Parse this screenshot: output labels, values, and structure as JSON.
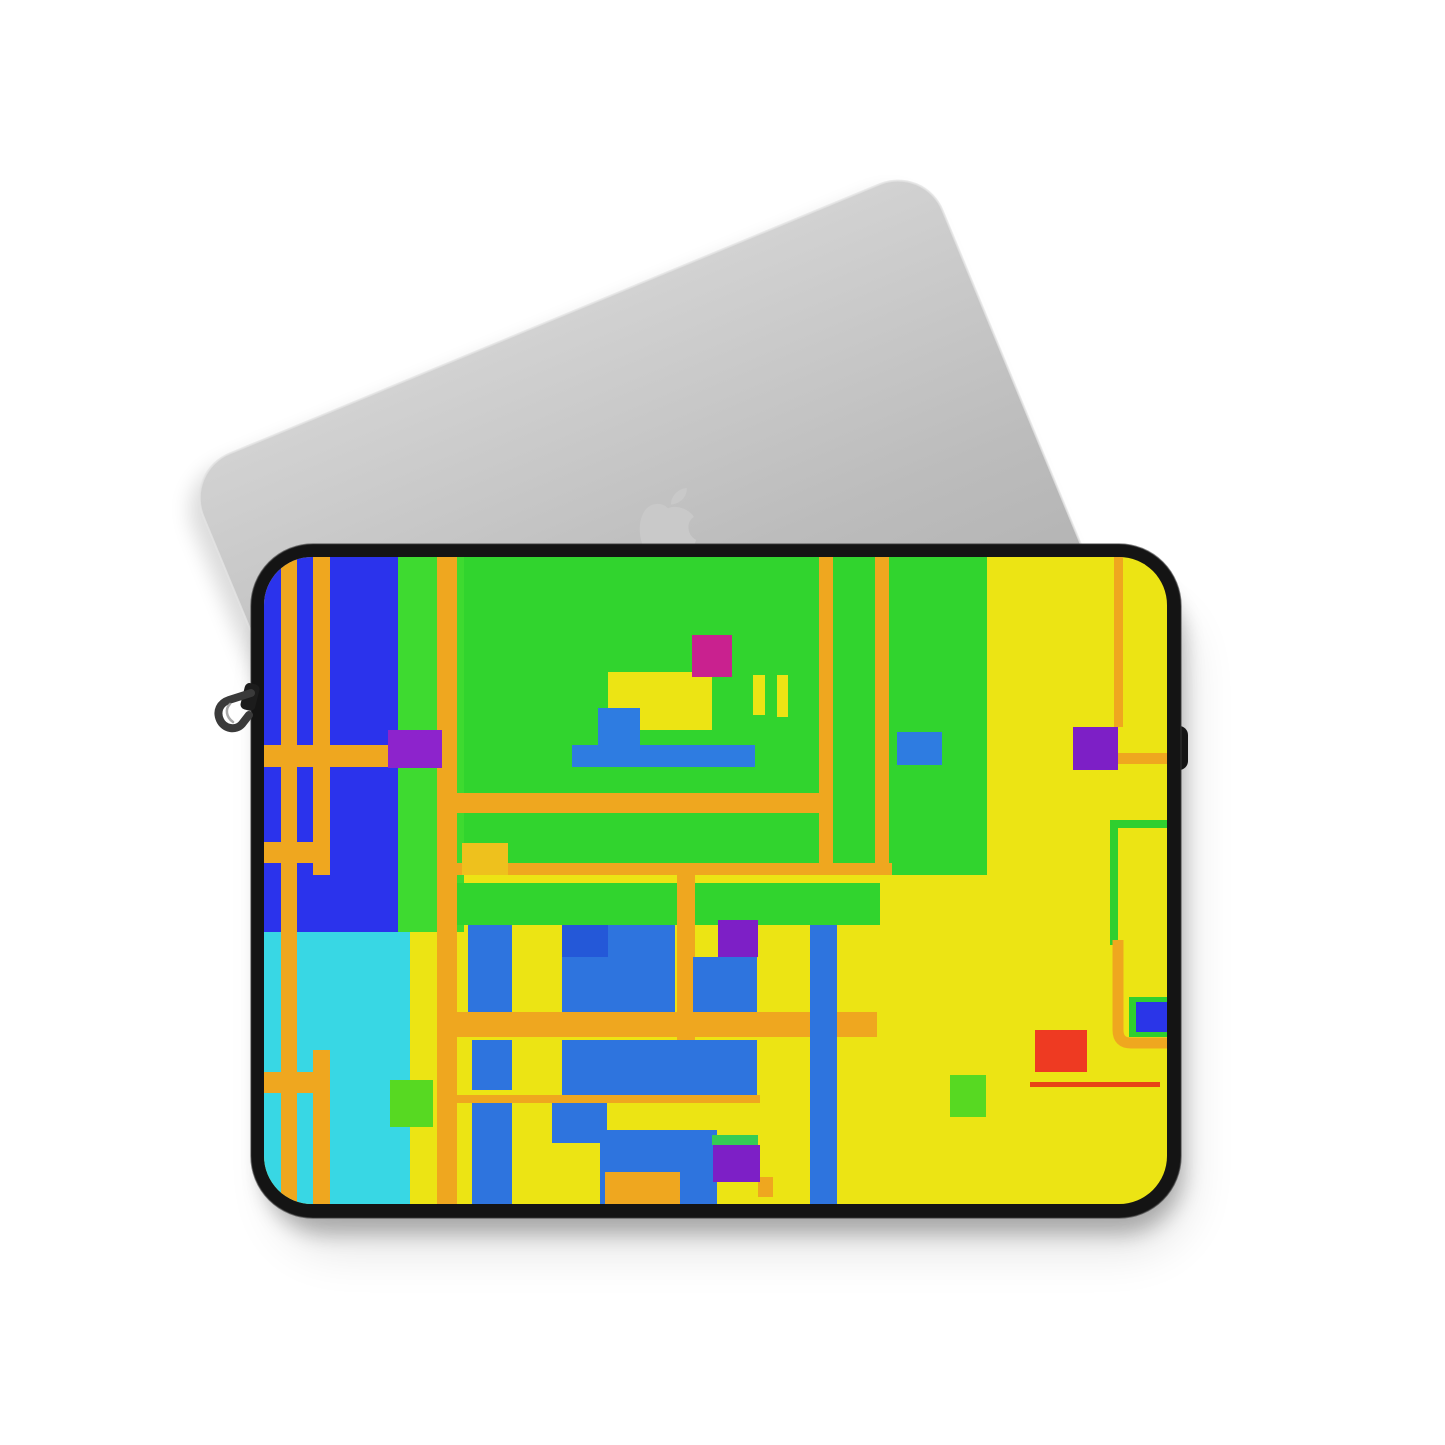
{
  "scene": {
    "background_color": "#ffffff",
    "width": 1445,
    "height": 1445,
    "objects": [
      "macbook-lid",
      "apple-logo",
      "laptop-sleeve",
      "zipper-pull"
    ]
  },
  "palette": {
    "laptop_gray_top": "#d0d0d0",
    "laptop_gray_bottom": "#a8a8a8",
    "laptop_rim": "#e4e4e4",
    "logo_gray": "#c9c9c9",
    "piping_black": "#141414",
    "piping_highlight": "#3a3a3a",
    "base_yellow": "#ece414",
    "field_blue": "#2b33ec",
    "field_cyan": "#38d7e4",
    "green_main": "#31d42e",
    "green_column": "#3eda30",
    "green_bright": "#2fcf2f",
    "orange": "#efa71f",
    "gold": "#eec11d",
    "motif_blue": "#2e7ce1",
    "bottom_blue": "#2e74de",
    "deep_blue": "#2458d8",
    "accent_blue": "#2a35e8",
    "magenta": "#c9218f",
    "purple": "#8d23cc",
    "purple_dark": "#7d1fc6",
    "red": "#ee3a22",
    "red_line": "#e84416",
    "small_green": "#57d922",
    "green_strip": "#35cc55",
    "zipper_metal": "#3a3a3a",
    "zipper_highlight": "#9a9a9a"
  },
  "laptop": {
    "x": 185,
    "y": 472,
    "rotation_deg": -22.5,
    "width": 800,
    "height": 640,
    "corner_radius": 48,
    "shadow": {
      "dx": -10,
      "dy": 12,
      "blur": 10,
      "opacity": 0.14
    },
    "logo": {
      "x": 632,
      "y": 483,
      "scale": 0.72,
      "body_path": "M50,35 C42,26 26,27 18,38 C6,55 10,85 22,99 C28,106 35,107 42,103 C47,100 53,100 58,103 C65,107 72,106 78,99 C83,93 87,86 89,79 C77,73 74,55 86,47 C78,35 60,30 50,35 Z",
      "leaf_path": "M54,30 C54,18 64,8 76,7 C77,19 67,29 54,30 Z"
    }
  },
  "sleeve": {
    "outer": {
      "x": 251,
      "y": 544,
      "w": 930,
      "h": 674,
      "r": 62
    },
    "inner": {
      "x": 264,
      "y": 557,
      "w": 903,
      "h": 647,
      "r": 48
    },
    "right_tab": {
      "x": 1162,
      "y": 726,
      "w": 26,
      "h": 44,
      "r": 9
    },
    "shadow1": {
      "x": 262,
      "y": 576,
      "w": 922,
      "h": 658,
      "r": 64,
      "blur": 14,
      "opacity": 0.26
    },
    "shadow2": {
      "x": 274,
      "y": 604,
      "w": 916,
      "h": 648,
      "r": 64,
      "blur": 26,
      "opacity": 0.1
    },
    "zipper": {
      "slider": {
        "x": 246,
        "y": 682,
        "w": 15,
        "h": 27,
        "r": 5,
        "rot": 14
      },
      "hook_path": "M251,693 L229,700 C220,703 216,711 220,720 C224,729 236,731 242,724 L249,715",
      "hook_width": 8,
      "highlight_path": "M230,704 C225,709 226,717 233,722",
      "highlight_width": 2.5
    }
  },
  "pattern": {
    "shapes": [
      {
        "type": "rect",
        "x": 264,
        "y": 557,
        "w": 134,
        "h": 375,
        "fill": "field_blue",
        "name": "blue-field"
      },
      {
        "type": "rect",
        "x": 264,
        "y": 932,
        "w": 146,
        "h": 272,
        "fill": "field_cyan",
        "name": "cyan-field"
      },
      {
        "type": "rect",
        "x": 398,
        "y": 557,
        "w": 66,
        "h": 375,
        "fill": "green_column",
        "name": "green-column"
      },
      {
        "type": "rect",
        "x": 464,
        "y": 557,
        "w": 523,
        "h": 318,
        "fill": "green_main",
        "name": "green-field"
      },
      {
        "type": "rect",
        "x": 457,
        "y": 883,
        "w": 423,
        "h": 42,
        "fill": "green_main",
        "name": "green-band"
      },
      {
        "type": "rect",
        "x": 281,
        "y": 557,
        "w": 16,
        "h": 647,
        "fill": "orange",
        "name": "orange-stripe-a"
      },
      {
        "type": "rect",
        "x": 313,
        "y": 557,
        "w": 17,
        "h": 318,
        "fill": "orange",
        "name": "orange-stripe-b"
      },
      {
        "type": "rect",
        "x": 313,
        "y": 1050,
        "w": 17,
        "h": 154,
        "fill": "orange",
        "name": "orange-stripe-b2"
      },
      {
        "type": "rect",
        "x": 437,
        "y": 557,
        "w": 20,
        "h": 647,
        "fill": "orange",
        "name": "orange-stripe-c"
      },
      {
        "type": "rect",
        "x": 819,
        "y": 557,
        "w": 14,
        "h": 318,
        "fill": "orange",
        "name": "orange-stripe-d"
      },
      {
        "type": "rect",
        "x": 875,
        "y": 557,
        "w": 14,
        "h": 318,
        "fill": "orange",
        "name": "orange-stripe-e"
      },
      {
        "type": "rect",
        "x": 264,
        "y": 745,
        "w": 134,
        "h": 22,
        "fill": "orange",
        "name": "orange-band-left-1"
      },
      {
        "type": "rect",
        "x": 264,
        "y": 842,
        "w": 66,
        "h": 21,
        "fill": "orange",
        "name": "orange-band-left-2"
      },
      {
        "type": "rect",
        "x": 264,
        "y": 1072,
        "w": 63,
        "h": 21,
        "fill": "orange",
        "name": "orange-band-left-3"
      },
      {
        "type": "rect",
        "x": 457,
        "y": 793,
        "w": 367,
        "h": 20,
        "fill": "orange",
        "name": "orange-band-center-1"
      },
      {
        "type": "rect",
        "x": 443,
        "y": 863,
        "w": 449,
        "h": 12,
        "fill": "orange",
        "name": "orange-band-center-2"
      },
      {
        "type": "rect",
        "x": 677,
        "y": 875,
        "w": 18,
        "h": 165,
        "fill": "orange",
        "name": "orange-connector"
      },
      {
        "type": "rect",
        "x": 447,
        "y": 1012,
        "w": 430,
        "h": 25,
        "fill": "orange",
        "name": "orange-band-bottom"
      },
      {
        "type": "rect",
        "x": 447,
        "y": 1095,
        "w": 313,
        "h": 8,
        "fill": "orange",
        "name": "orange-thin-line"
      },
      {
        "type": "rect",
        "x": 1114,
        "y": 557,
        "w": 9,
        "h": 170,
        "fill": "orange",
        "name": "orange-right-vertical"
      },
      {
        "type": "rect",
        "x": 1118,
        "y": 753,
        "w": 53,
        "h": 11,
        "fill": "orange",
        "name": "orange-right-horizontal"
      },
      {
        "type": "rect",
        "x": 608,
        "y": 672,
        "w": 104,
        "h": 58,
        "fill": "base_yellow",
        "name": "motif-yellow-block"
      },
      {
        "type": "rect",
        "x": 462,
        "y": 843,
        "w": 46,
        "h": 32,
        "fill": "gold",
        "name": "gold-block"
      },
      {
        "type": "rect",
        "x": 692,
        "y": 635,
        "w": 40,
        "h": 42,
        "fill": "magenta",
        "name": "magenta-square"
      },
      {
        "type": "rect",
        "x": 753,
        "y": 675,
        "w": 12,
        "h": 40,
        "fill": "base_yellow",
        "name": "yellow-tick-1"
      },
      {
        "type": "rect",
        "x": 777,
        "y": 675,
        "w": 11,
        "h": 42,
        "fill": "base_yellow",
        "name": "yellow-tick-2"
      },
      {
        "type": "rect",
        "x": 598,
        "y": 708,
        "w": 42,
        "h": 37,
        "fill": "motif_blue",
        "name": "motif-blue-vertical"
      },
      {
        "type": "rect",
        "x": 572,
        "y": 745,
        "w": 183,
        "h": 22,
        "fill": "motif_blue",
        "name": "motif-blue-bar"
      },
      {
        "type": "rect",
        "x": 388,
        "y": 730,
        "w": 54,
        "h": 38,
        "fill": "purple",
        "name": "purple-square-left"
      },
      {
        "type": "rect",
        "x": 1073,
        "y": 727,
        "w": 45,
        "h": 43,
        "fill": "purple_dark",
        "name": "purple-square-right"
      },
      {
        "type": "rect",
        "x": 897,
        "y": 732,
        "w": 45,
        "h": 33,
        "fill": "motif_blue",
        "name": "blue-square-on-green"
      },
      {
        "type": "rect",
        "x": 1110,
        "y": 820,
        "w": 61,
        "h": 8,
        "fill": "green_bright",
        "name": "green-frame-top"
      },
      {
        "type": "rect",
        "x": 1110,
        "y": 820,
        "w": 8,
        "h": 125,
        "fill": "green_bright",
        "name": "green-frame-left"
      },
      {
        "type": "rect",
        "x": 718,
        "y": 920,
        "w": 40,
        "h": 37,
        "fill": "purple_dark",
        "name": "purple-square-mid"
      },
      {
        "type": "rect",
        "x": 468,
        "y": 925,
        "w": 44,
        "h": 87,
        "fill": "bottom_blue",
        "name": "blue-column-1"
      },
      {
        "type": "rect",
        "x": 562,
        "y": 925,
        "w": 113,
        "h": 87,
        "fill": "bottom_blue",
        "name": "blue-block-1"
      },
      {
        "type": "rect",
        "x": 562,
        "y": 925,
        "w": 46,
        "h": 32,
        "fill": "deep_blue",
        "name": "blue-block-1-sub"
      },
      {
        "type": "rect",
        "x": 693,
        "y": 957,
        "w": 64,
        "h": 55,
        "fill": "bottom_blue",
        "name": "blue-block-2"
      },
      {
        "type": "rect",
        "x": 810,
        "y": 925,
        "w": 27,
        "h": 279,
        "fill": "bottom_blue",
        "name": "blue-column-tall"
      },
      {
        "type": "rect",
        "x": 562,
        "y": 1040,
        "w": 195,
        "h": 55,
        "fill": "bottom_blue",
        "name": "blue-block-3"
      },
      {
        "type": "rect",
        "x": 472,
        "y": 1040,
        "w": 40,
        "h": 50,
        "fill": "bottom_blue",
        "name": "blue-column-2"
      },
      {
        "type": "rect",
        "x": 472,
        "y": 1103,
        "w": 40,
        "h": 101,
        "fill": "bottom_blue",
        "name": "blue-column-3"
      },
      {
        "type": "rect",
        "x": 552,
        "y": 1103,
        "w": 55,
        "h": 40,
        "fill": "bottom_blue",
        "name": "blue-block-4"
      },
      {
        "type": "rect",
        "x": 600,
        "y": 1130,
        "w": 117,
        "h": 77,
        "fill": "bottom_blue",
        "name": "blue-block-5"
      },
      {
        "type": "rect",
        "x": 605,
        "y": 1172,
        "w": 75,
        "h": 32,
        "fill": "orange",
        "name": "orange-block-bottom"
      },
      {
        "type": "rect",
        "x": 758,
        "y": 1177,
        "w": 15,
        "h": 20,
        "fill": "orange",
        "name": "orange-stub"
      },
      {
        "type": "rect",
        "x": 712,
        "y": 1135,
        "w": 46,
        "h": 10,
        "fill": "green_strip",
        "name": "green-strip"
      },
      {
        "type": "rect",
        "x": 713,
        "y": 1145,
        "w": 47,
        "h": 37,
        "fill": "purple_dark",
        "name": "purple-square-bottom"
      },
      {
        "type": "rect",
        "x": 390,
        "y": 1080,
        "w": 43,
        "h": 47,
        "fill": "small_green",
        "name": "green-square-left"
      },
      {
        "type": "rect",
        "x": 950,
        "y": 1075,
        "w": 36,
        "h": 42,
        "fill": "small_green",
        "name": "green-square-right"
      },
      {
        "type": "rect",
        "x": 1030,
        "y": 1082,
        "w": 130,
        "h": 5,
        "fill": "red_line",
        "name": "red-line"
      },
      {
        "type": "rect",
        "x": 1035,
        "y": 1030,
        "w": 52,
        "h": 42,
        "fill": "red",
        "name": "red-square"
      },
      {
        "type": "path",
        "d": "M1118,940 L1118,1030 Q1118,1043 1131,1043 L1171,1043",
        "stroke": "orange",
        "sw": 11,
        "name": "orange-bracket"
      },
      {
        "type": "rect",
        "x": 1129,
        "y": 997,
        "w": 42,
        "h": 40,
        "fill": "green_bright",
        "name": "green-square-frame"
      },
      {
        "type": "rect",
        "x": 1136,
        "y": 1002,
        "w": 35,
        "h": 30,
        "fill": "accent_blue",
        "name": "blue-square-frame"
      }
    ]
  }
}
